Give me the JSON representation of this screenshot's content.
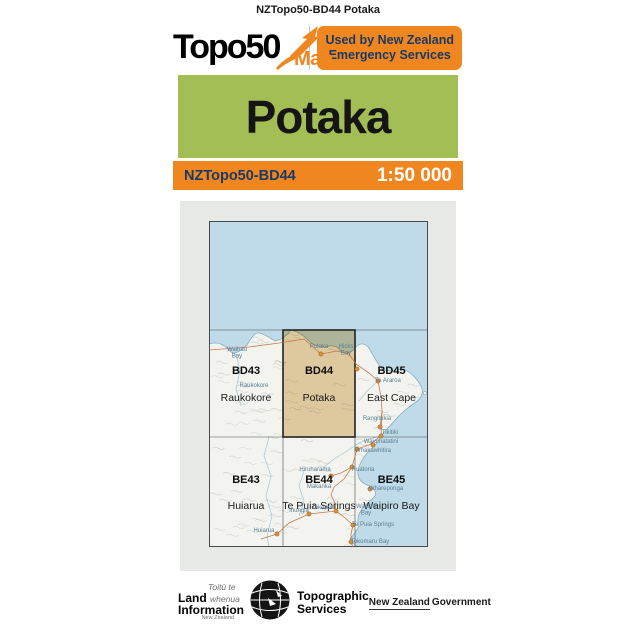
{
  "page": {
    "top_title": "NZTopo50-BD44 Potaka"
  },
  "header": {
    "logo_topo50": "Topo50",
    "logo_map": "Map",
    "badge_line1": "Used by New Zealand",
    "badge_line2": "Emergency Services"
  },
  "title_band": {
    "title": "Potaka"
  },
  "scale_band": {
    "sheet_code": "NZTopo50-BD44",
    "scale": "1:50 000"
  },
  "colors": {
    "orange": "#F0861F",
    "green": "#A2BE55",
    "navy": "#1A3A64",
    "sea": "#BFDBE9",
    "panel": "#E6E9E6",
    "land": "#F3F4F0",
    "coast": "#85ADC0",
    "highlight": "#E6CD9E",
    "road": "#C4703C",
    "river": "#9FC6D8",
    "dot": "#DE8F3A",
    "label_blue": "#587E92",
    "grid": "#4a4a4a"
  },
  "map_index": {
    "grid": {
      "cols": [
        0,
        74,
        146,
        219
      ],
      "rows": [
        0,
        109,
        216,
        326
      ]
    },
    "sheets": [
      {
        "code": "BD43",
        "name": "Raukokore",
        "col": 0,
        "row": 1,
        "highlighted": false
      },
      {
        "code": "BD44",
        "name": "Potaka",
        "col": 1,
        "row": 1,
        "highlighted": true
      },
      {
        "code": "BD45",
        "name": "East Cape",
        "col": 2,
        "row": 1,
        "highlighted": false
      },
      {
        "code": "BE43",
        "name": "Huiarua",
        "col": 0,
        "row": 2,
        "highlighted": false
      },
      {
        "code": "BE44",
        "name": "Te Puia Springs",
        "col": 1,
        "row": 2,
        "highlighted": false
      },
      {
        "code": "BE45",
        "name": "Waipiro Bay",
        "col": 2,
        "row": 2,
        "highlighted": false
      }
    ],
    "coast": "M0,123 C10,120 16,124 22,131 C27,134 32,129 38,124 C42,117 46,111 50,112 C56,113 61,117 66,120 C71,119 76,117 82,109 C87,110 93,113 99,119 C104,124 110,126 116,126 C122,124 127,124 132,130 C136,133 141,133 146,127 C150,122 155,121 160,127 C164,134 168,142 173,148 C179,151 186,150 193,148 C200,150 207,156 212,165 C215,171 213,177 207,181 C200,186 193,191 187,198 C181,205 176,210 172,215 C170,220 167,224 161,229 C156,234 151,241 149,249 C148,256 151,261 158,264 C164,266 168,270 166,275 C162,280 156,284 153,288 C149,294 148,300 150,305 C148,310 144,314 141,318 C143,322 146,324 149,326 L0,326 Z",
    "places": [
      {
        "lines": [
          "Waihau",
          "Bay"
        ],
        "lx": 28,
        "ly": 130
      },
      {
        "lines": [
          "Raukokore"
        ],
        "lx": 45,
        "ly": 166
      },
      {
        "lines": [
          "Potaka"
        ],
        "lx": 110,
        "ly": 127,
        "dot": [
          112,
          133
        ]
      },
      {
        "lines": [
          "Hicks",
          "Bay"
        ],
        "lx": 137,
        "ly": 127,
        "dot": [
          148,
          148
        ]
      },
      {
        "lines": [
          "Te Araroa"
        ],
        "lx": 179,
        "ly": 161,
        "dot": [
          169,
          160
        ]
      },
      {
        "lines": [
          "Rangitukia"
        ],
        "lx": 168,
        "ly": 199,
        "dot": [
          171,
          206
        ]
      },
      {
        "lines": [
          "Tikitiki"
        ],
        "lx": 181,
        "ly": 213,
        "dot": [
          172,
          215
        ]
      },
      {
        "lines": [
          "Waiomatatini"
        ],
        "lx": 172,
        "ly": 222,
        "dot": [
          164,
          224
        ]
      },
      {
        "lines": [
          "Whakawhitira"
        ],
        "lx": 164,
        "ly": 231,
        "dot": [
          148,
          228
        ]
      },
      {
        "lines": [
          "Hiruharama"
        ],
        "lx": 106,
        "ly": 250,
        "dot": [
          122,
          255
        ]
      },
      {
        "lines": [
          "Ruatoria"
        ],
        "lx": 154,
        "ly": 250,
        "dot": [
          143,
          246
        ]
      },
      {
        "lines": [
          "Makarika"
        ],
        "lx": 110,
        "ly": 267
      },
      {
        "lines": [
          "Whareponga"
        ],
        "lx": 177,
        "ly": 269,
        "dot": [
          161,
          268
        ]
      },
      {
        "lines": [
          "Waipiro",
          "Bay"
        ],
        "lx": 157,
        "ly": 287
      },
      {
        "lines": [
          "Takapau"
        ],
        "lx": 114,
        "ly": 288,
        "dot": [
          127,
          290
        ]
      },
      {
        "lines": [
          "Ihungia"
        ],
        "lx": 90,
        "ly": 291,
        "dot": [
          100,
          293
        ]
      },
      {
        "lines": [
          "Te Puia Springs"
        ],
        "lx": 164,
        "ly": 305,
        "dot": [
          144,
          304
        ]
      },
      {
        "lines": [
          "Tokomaru Bay"
        ],
        "lx": 161,
        "ly": 322,
        "dot": [
          142,
          321
        ]
      },
      {
        "lines": [
          "Huiarua"
        ],
        "lx": 55,
        "ly": 311,
        "dot": [
          68,
          313
        ]
      }
    ],
    "roads": [
      [
        [
          0,
          129
        ],
        [
          40,
          126
        ],
        [
          70,
          122
        ],
        [
          95,
          118
        ],
        [
          112,
          133
        ],
        [
          128,
          130
        ],
        [
          140,
          133
        ],
        [
          147,
          143
        ],
        [
          160,
          152
        ],
        [
          169,
          160
        ]
      ],
      [
        [
          169,
          160
        ],
        [
          172,
          176
        ],
        [
          173,
          190
        ],
        [
          172,
          215
        ],
        [
          160,
          224
        ],
        [
          148,
          228
        ],
        [
          143,
          246
        ],
        [
          135,
          258
        ],
        [
          125,
          266
        ],
        [
          122,
          274
        ],
        [
          126,
          282
        ],
        [
          127,
          290
        ],
        [
          135,
          296
        ],
        [
          144,
          304
        ],
        [
          142,
          313
        ],
        [
          142,
          321
        ],
        [
          144,
          326
        ]
      ],
      [
        [
          173,
          190
        ],
        [
          171,
          206
        ]
      ],
      [
        [
          127,
          290
        ],
        [
          100,
          293
        ],
        [
          80,
          302
        ],
        [
          68,
          313
        ],
        [
          52,
          318
        ]
      ],
      [
        [
          143,
          246
        ],
        [
          132,
          252
        ],
        [
          122,
          255
        ]
      ]
    ],
    "rivers": [
      [
        [
          172,
          215
        ],
        [
          160,
          218
        ],
        [
          150,
          222
        ],
        [
          138,
          230
        ],
        [
          125,
          238
        ],
        [
          115,
          246
        ]
      ],
      [
        [
          169,
          160
        ],
        [
          158,
          170
        ],
        [
          150,
          180
        ]
      ],
      [
        [
          27,
          133
        ],
        [
          31,
          150
        ],
        [
          27,
          168
        ],
        [
          32,
          185
        ]
      ],
      [
        [
          60,
          216
        ],
        [
          55,
          235
        ],
        [
          62,
          255
        ],
        [
          57,
          275
        ],
        [
          63,
          295
        ],
        [
          58,
          315
        ],
        [
          60,
          326
        ]
      ],
      [
        [
          95,
          250
        ],
        [
          90,
          265
        ],
        [
          95,
          280
        ],
        [
          90,
          295
        ]
      ]
    ]
  },
  "footer": {
    "linz": {
      "toitu": "Toitū te",
      "land": "Land",
      "whenua": "whenua",
      "information": "Information",
      "new_zealand": "New Zealand"
    },
    "topographic": {
      "line1": "Topographic",
      "line2": "Services"
    },
    "government": {
      "underlined": "New Zealand",
      "rest": "Government"
    }
  }
}
